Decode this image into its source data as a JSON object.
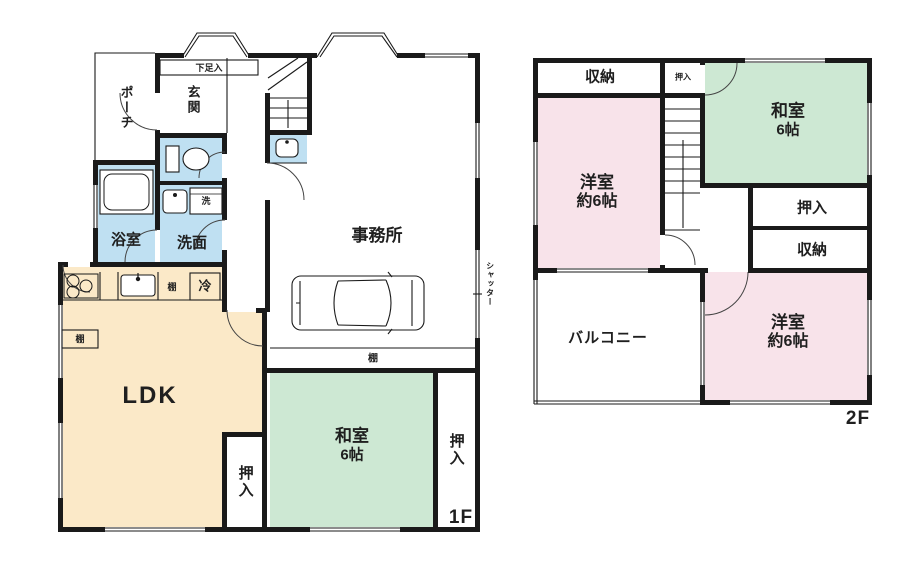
{
  "floor1": {
    "floor_label": "1F",
    "rooms": {
      "porch": "ポーチ",
      "shoe_storage": "下足入",
      "entrance": "玄関",
      "bath": "浴室",
      "washroom": "洗面",
      "laundry": "洗",
      "office": "事務所",
      "shutter": "シャッター",
      "ldk": "LDK",
      "fridge": "冷",
      "shelf_kitchen": "棚",
      "shelf_wall": "棚",
      "shelf_office": "棚",
      "japanese_room": "和室",
      "japanese_room_size": "6帖",
      "closet_ldk": "押入",
      "closet_washitsu": "押入"
    }
  },
  "floor2": {
    "floor_label": "2F",
    "rooms": {
      "storage_nw": "収納",
      "closet_top": "押入",
      "japanese_room": "和室",
      "japanese_room_size": "6帖",
      "western_room_1": "洋室",
      "western_room_1_size": "約6帖",
      "closet_mid": "押入",
      "storage_mid": "収納",
      "balcony": "バルコニー",
      "western_room_2": "洋室",
      "western_room_2_size": "約6帖"
    }
  },
  "colors": {
    "wet_area": "#bfe0f2",
    "tatami_room": "#cde8d3",
    "western_room": "#f8e3ea",
    "ldk": "#fbe9c8",
    "wall": "#1a1a1a"
  }
}
